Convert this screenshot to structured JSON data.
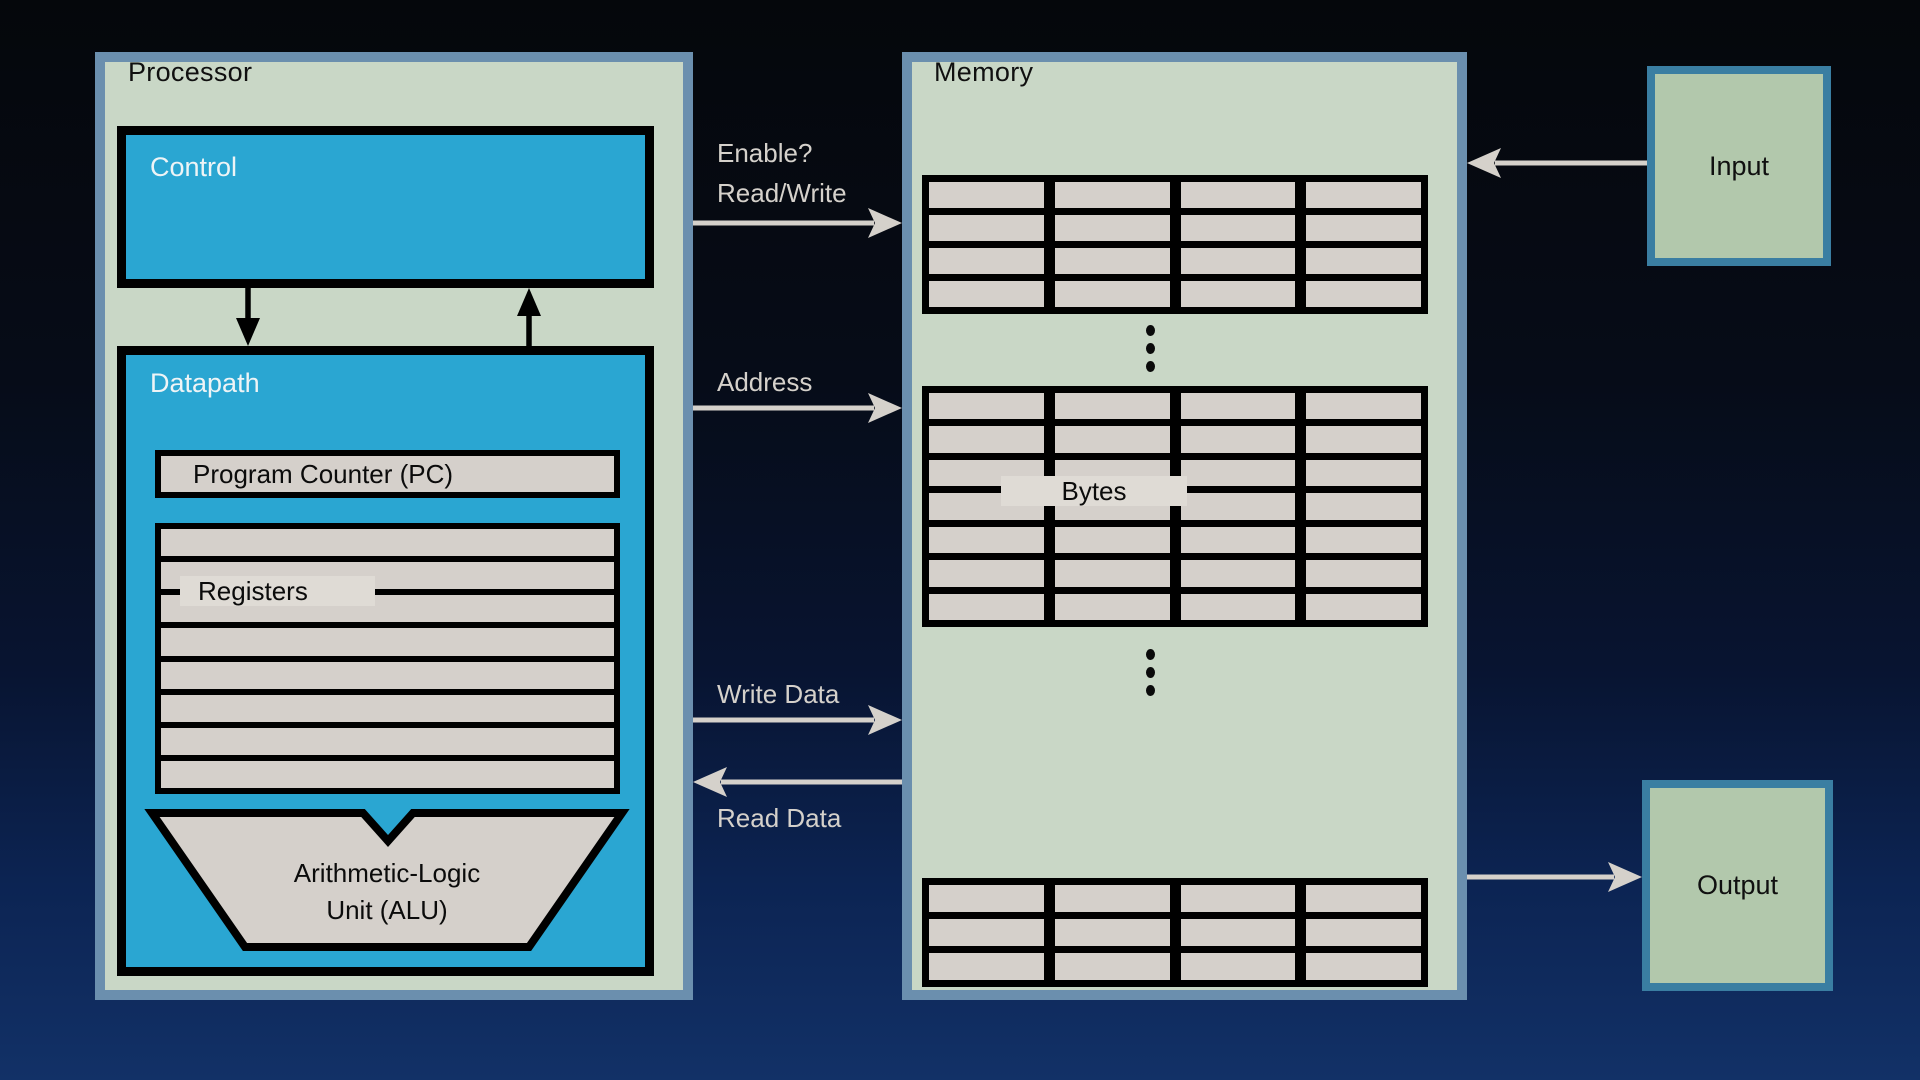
{
  "colors": {
    "background_top": "#05070b",
    "background_bottom": "#123167",
    "panel_fill": "#c9d7c6",
    "panel_border": "#6b8fae",
    "block_fill": "#2aa6d2",
    "cell_fill": "#d5d0cb",
    "label_strip_fill": "#dfdbd5",
    "arrow_gray": "#d5d1cb",
    "io_fill": "#b2c8ac",
    "io_border": "#3a7ea2"
  },
  "processor": {
    "title": "Processor",
    "control_label": "Control",
    "datapath_label": "Datapath",
    "program_counter_label": "Program Counter (PC)",
    "registers_label": "Registers",
    "register_grid": {
      "rows": 8,
      "cols": 1
    },
    "alu_line1": "Arithmetic-Logic",
    "alu_line2": "Unit (ALU)"
  },
  "memory": {
    "title": "Memory",
    "bytes_label": "Bytes",
    "tables": [
      {
        "rows": 4,
        "cols": 4
      },
      {
        "rows": 7,
        "cols": 4
      },
      {
        "rows": 3,
        "cols": 4
      }
    ]
  },
  "buses": {
    "enable_label": "Enable?",
    "read_write_label": "Read/Write",
    "address_label": "Address",
    "write_data_label": "Write Data",
    "read_data_label": "Read Data"
  },
  "io": {
    "input_label": "Input",
    "output_label": "Output"
  }
}
